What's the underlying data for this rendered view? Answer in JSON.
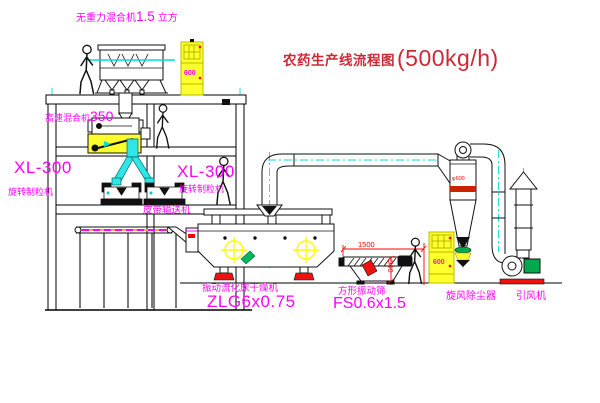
{
  "title": {
    "text": "农药生产线流程图",
    "capacity": "(500kg/h)"
  },
  "equipment": {
    "gravity_mixer": {
      "label": "无重力混合机",
      "size": "1.5",
      "unit": "立方"
    },
    "mixer_350": {
      "label": "高速混合机",
      "model": "350"
    },
    "granulator_left": {
      "model": "XL-300",
      "label": "旋转制粒机"
    },
    "granulator_right": {
      "model": "XL-300",
      "label": "旋转制粒机"
    },
    "belt_conveyor": {
      "label": "皮带输送机"
    },
    "fluid_bed_dryer": {
      "label": "振动流化床干燥机",
      "model": "ZLG6x0.75"
    },
    "vibrating_sieve": {
      "label": "方形振动筛",
      "model": "FS0.6x1.5"
    },
    "cyclone": {
      "label": "旋风除尘器",
      "diameter": "φ600"
    },
    "induced_draft_fan": {
      "label": "引风机"
    },
    "control_cabinet_top": {
      "display": "600"
    },
    "control_cabinet_right": {
      "display": "600"
    }
  },
  "dimensions": {
    "sieve_length": "1500",
    "sieve_height": "540"
  },
  "colors": {
    "label_magenta": "#ff00ff",
    "title_red": "#cc2936",
    "dimension_red": "#ff0000",
    "centerline_cyan": "#00dddd",
    "highlight_yellow": "#ffff2e",
    "machine_green": "#00a84e"
  }
}
